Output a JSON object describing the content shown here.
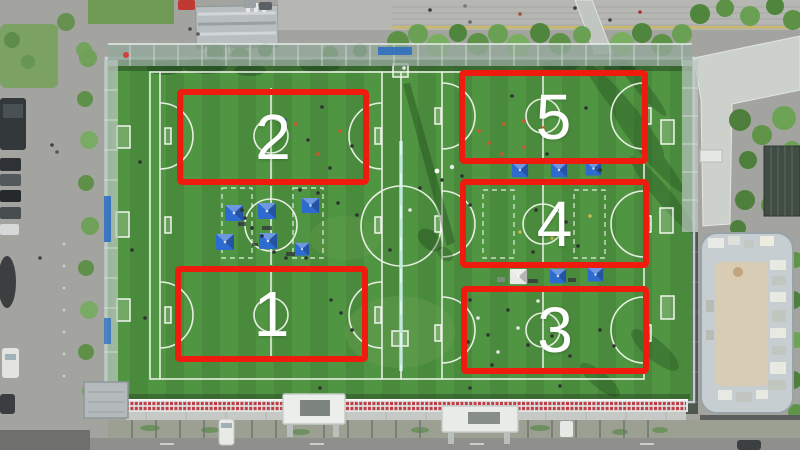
{
  "scene": {
    "description": "Drone aerial view of an artificial-turf football complex with five mini pitches outlined in red",
    "surroundings": [
      "parking lot with cars",
      "tree-lined walkway",
      "plaza with pedestrians",
      "rooftop building",
      "grandstand seating",
      "street"
    ]
  },
  "annotations": {
    "highlight_color": "#ee1b0e",
    "label_color": "#ffffff",
    "fields": [
      {
        "id": "field-1",
        "label": "1",
        "position": "bottom-left"
      },
      {
        "id": "field-2",
        "label": "2",
        "position": "top-left"
      },
      {
        "id": "field-3",
        "label": "3",
        "position": "bottom-right"
      },
      {
        "id": "field-4",
        "label": "4",
        "position": "middle-right"
      },
      {
        "id": "field-5",
        "label": "5",
        "position": "top-right"
      }
    ]
  },
  "objects": {
    "numbered_pitches": 5,
    "blue_tents": 11,
    "white_tents": 1,
    "divider_net": 1
  },
  "palette": {
    "turf_green": "#4a8a3c",
    "turf_stripe": "#57a047",
    "line_white": "#eef3ea",
    "tent_blue": "#2e6bd0",
    "tent_white": "#e8eae7",
    "bleacher_red": "#c13f47",
    "pavement_gray": "#a3a3a0",
    "tree_green": "#5c9146",
    "net_teal": "#bfeadf"
  }
}
